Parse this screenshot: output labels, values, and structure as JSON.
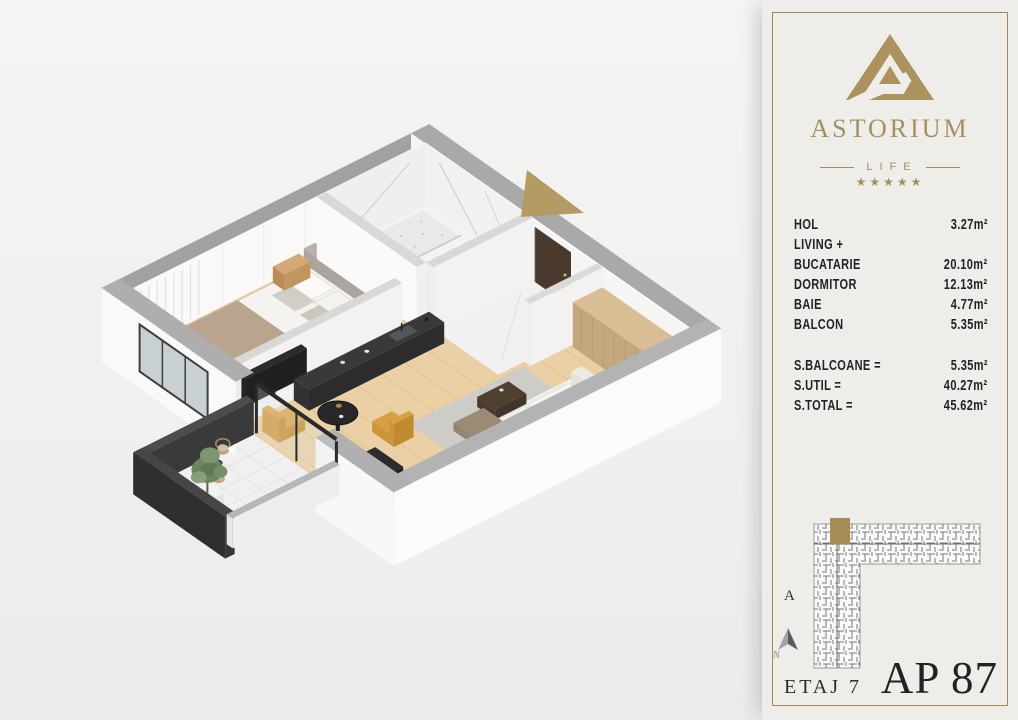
{
  "branding": {
    "name": "ASTORIUM",
    "subtitle": "LIFE",
    "stars": "★★★★★"
  },
  "areas": {
    "rows": [
      {
        "label": "HOL",
        "value": "3.27m²"
      },
      {
        "label": "LIVING +",
        "value": ""
      },
      {
        "label": "BUCATARIE",
        "value": "20.10m²"
      },
      {
        "label": "DORMITOR",
        "value": "12.13m²"
      },
      {
        "label": "BAIE",
        "value": "4.77m²"
      },
      {
        "label": "BALCON",
        "value": "5.35m²"
      }
    ],
    "totals": [
      {
        "label": "S.BALCOANE =",
        "value": "5.35m²"
      },
      {
        "label": "S.UTIL =",
        "value": "40.27m²"
      },
      {
        "label": "S.TOTAL =",
        "value": "45.62m²"
      }
    ]
  },
  "site_plan": {
    "section_label": "A",
    "compass_label": "N"
  },
  "footer": {
    "floor_label": "ETAJ 7",
    "apartment_label": "AP 87"
  },
  "colors": {
    "gold": "#a68f5f",
    "arrow_gold": "#b49a63",
    "text": "#26262a",
    "unit_highlight": "#a68d55"
  }
}
